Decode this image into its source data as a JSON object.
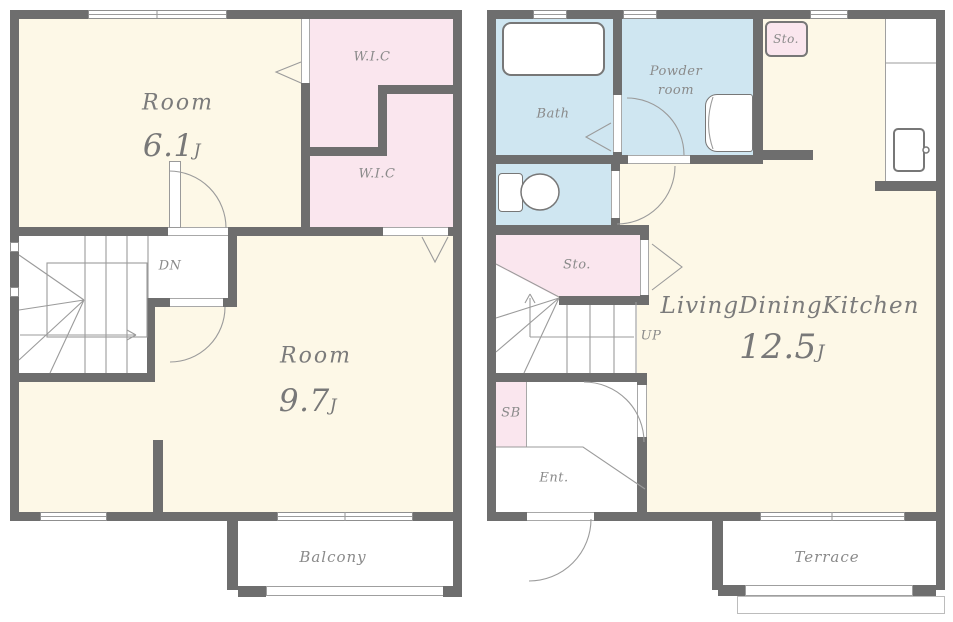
{
  "colors": {
    "wall": "#6e6e6e",
    "cream": "#fdf8e7",
    "pink": "#fae6ee",
    "blue": "#cfe6f1",
    "line": "#9b9b9b",
    "label": "#8a8a8a",
    "fixture": "#777777"
  },
  "floor2": {
    "room_61": {
      "name": "Room",
      "size": "6.1",
      "unit": "J"
    },
    "wic_upper": "W.I.C",
    "wic_lower": "W.I.C",
    "dn": "DN",
    "room_97": {
      "name": "Room",
      "size": "9.7",
      "unit": "J"
    },
    "balcony": "Balcony"
  },
  "floor1": {
    "bath": "Bath",
    "powder_room": {
      "line1": "Powder",
      "line2": "room"
    },
    "sto_closet": "Sto.",
    "sto_room": "Sto.",
    "up": "UP",
    "ldk": {
      "name": "LivingDiningKitchen",
      "size": "12.5",
      "unit": "J"
    },
    "sb": "SB",
    "entrance": "Ent.",
    "terrace": "Terrace"
  }
}
